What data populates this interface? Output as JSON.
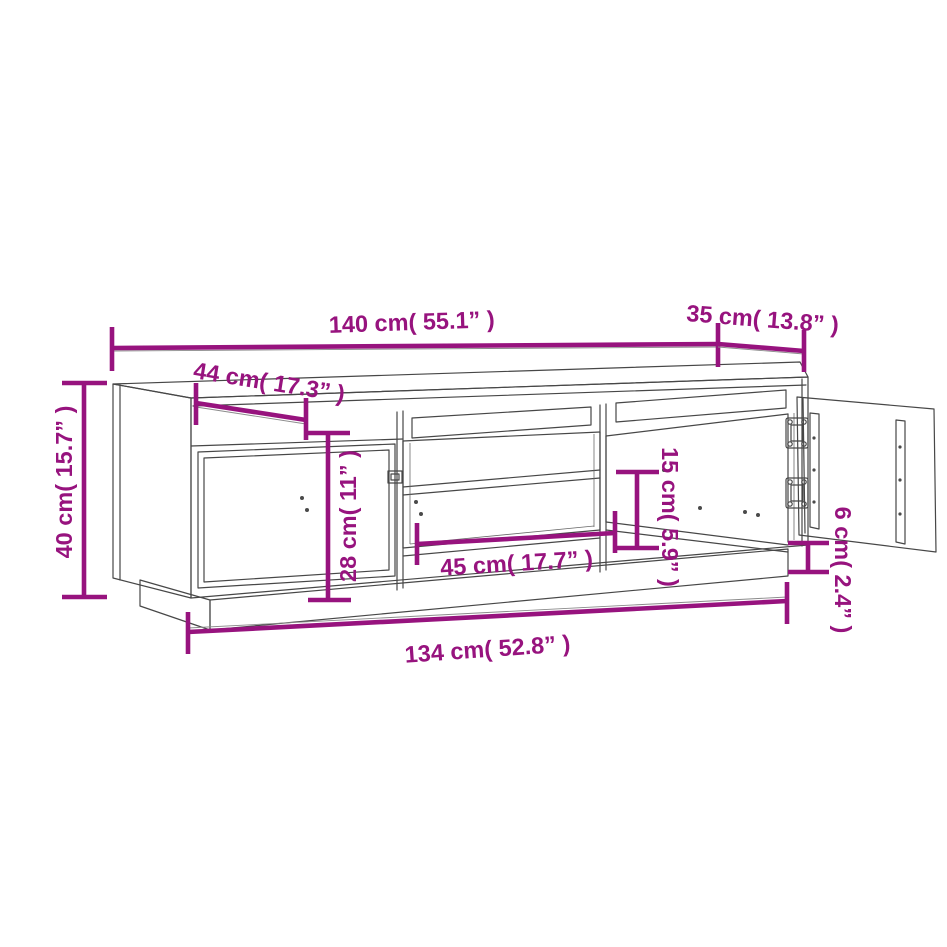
{
  "diagram": {
    "title": "TV cabinet dimension diagram",
    "accent_color": "#97137E",
    "outline_color": "#474747",
    "background_color": "#FFFFFF",
    "dimensions": {
      "top_width": "140 cm( 55.1” )",
      "top_right_depth": "35 cm( 13.8” )",
      "left_top_depth": "44 cm( 17.3” )",
      "overall_height": "40 cm( 15.7” )",
      "left_inner_height": "28 cm( 11” )",
      "center_shelf_width": "45 cm( 17.7” )",
      "right_inner_height": "15 cm( 5.9” )",
      "base_height": "6 cm( 2.4” )",
      "base_width": "134 cm( 52.8” )"
    }
  }
}
